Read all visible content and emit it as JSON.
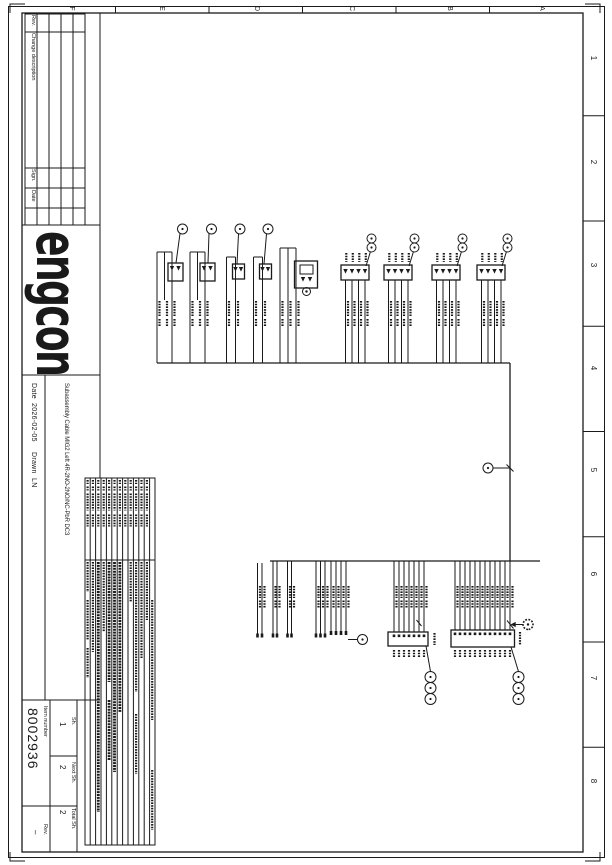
{
  "grid": {
    "cols": [
      "1",
      "2",
      "3",
      "4",
      "5",
      "6",
      "7",
      "8"
    ],
    "rows": [
      "A",
      "B",
      "C",
      "D",
      "E",
      "F"
    ]
  },
  "revision_table": {
    "rev_label": "Rev.",
    "change_label": "Change description",
    "sign_label": "Sign.",
    "date_label": "Date"
  },
  "title_block": {
    "logo": "engcon",
    "title": "Subassembly Cable MIG2 Left 4R-2NO-2NO/NC-PbR DC3",
    "date_label": "Date",
    "date_value": "2026-02-05",
    "drawn_label": "Drawn",
    "drawn_value": "LN",
    "item_number_label": "Item number",
    "item_number": "8002936",
    "sheet_label": "Sh.",
    "sheet_value": "1",
    "next_sheet_label": "Next Sh.",
    "next_sheet_value": "2",
    "total_sheet_label": "Total Sh.",
    "total_sheet_value": "2",
    "rev_label": "Rev.",
    "rev_value": "–"
  },
  "colors": {
    "ink": "#1a1a1a",
    "paper": "#ffffff"
  }
}
